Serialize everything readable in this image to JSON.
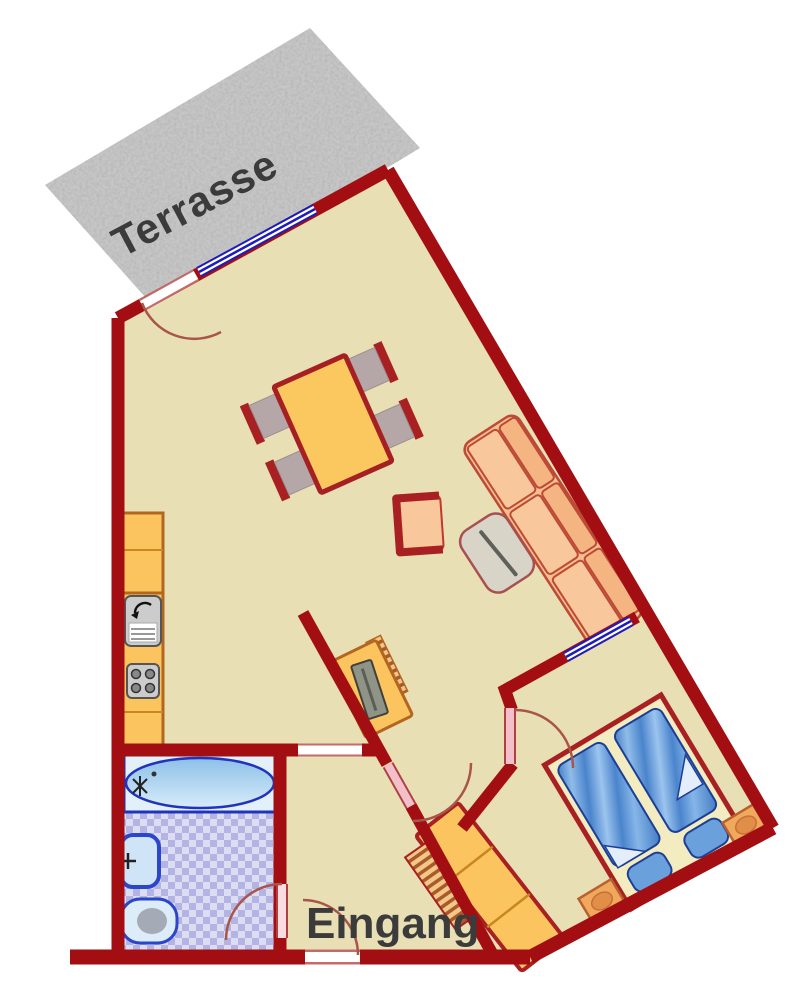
{
  "labels": {
    "terrace": "Terrasse",
    "entrance": "Eingang"
  },
  "colors": {
    "background": "#ffffff",
    "wall": "#a30e12",
    "floor": "#e9dfb4",
    "terrace_gray": "#c6c6c6",
    "label_text": "#3b3b3b",
    "counter_orange": "#fbc45f",
    "counter_border": "#b3661f",
    "table_border": "#a61f23",
    "chair_seat": "#b5a7a7",
    "sofa_peach": "#f8c79c",
    "sofa_border": "#bd4a35",
    "coffee_table_gray": "#d8d4c8",
    "bath_check_light": "#dcdcf2",
    "bath_check_dark": "#b4b4e4",
    "fixture_fill": "#cfe4f6",
    "fixture_border": "#2b46c8",
    "mattress_blue": "#4f86c8",
    "bed_frame_cream": "#f3ecc0",
    "pillow_blue": "#6aa0dc",
    "nightstand_orange": "#f0a85c",
    "door_leaf_pink": "#f2bfca",
    "door_frame_pink": "#c46a6a",
    "window_navy": "#1d1dbe",
    "door_arc": "#a85648"
  },
  "furniture_icons": [
    "dining-table",
    "dining-chair",
    "sofa",
    "coffee-table",
    "armchair",
    "tv-bench",
    "kitchen-counter",
    "kitchen-sink",
    "stove",
    "bathtub",
    "washbasin",
    "toilet",
    "double-bed",
    "pillow",
    "nightstand",
    "wardrobe",
    "shoe-rack"
  ],
  "openings": [
    "terrace-door",
    "terrace-window",
    "hallway-opening",
    "vestibule-door",
    "bedroom-door",
    "bedroom-window",
    "bathroom-door",
    "entrance-door"
  ]
}
